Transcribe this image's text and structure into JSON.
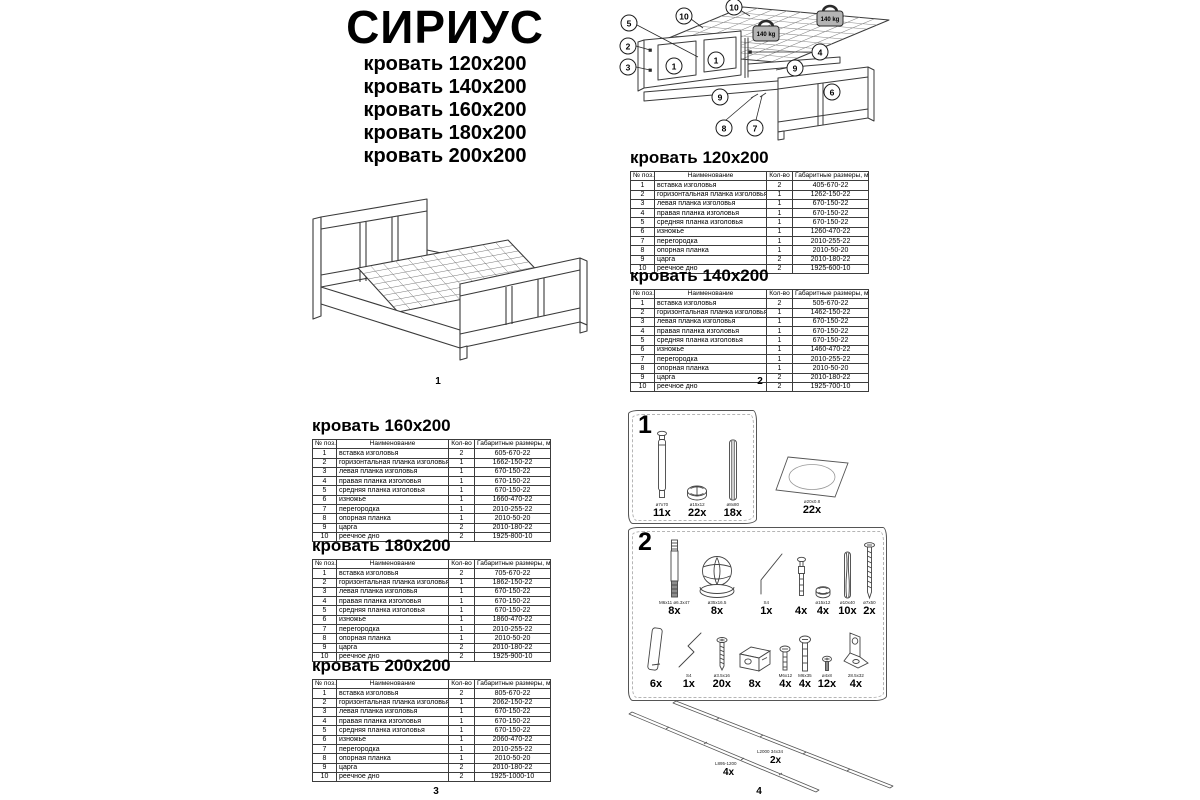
{
  "page": {
    "title": "СИРИУС",
    "sizes": [
      "кровать 120х200",
      "кровать 140х200",
      "кровать 160х200",
      "кровать 180х200",
      "кровать 200х200"
    ],
    "page_numbers": [
      "1",
      "2",
      "3",
      "4"
    ]
  },
  "table_header": [
    "№ поз.",
    "Наименование",
    "Кол-во",
    "Габаритные размеры, мм"
  ],
  "part_names": [
    "вставка изголовья",
    "горизонтальная планка изголовья",
    "левая планка изголовья",
    "правая планка изголовья",
    "средняя планка изголовья",
    "изножье",
    "перегородка",
    "опорная планка",
    "царга",
    "реечное дно"
  ],
  "quantities": [
    "2",
    "1",
    "1",
    "1",
    "1",
    "1",
    "1",
    "1",
    "2",
    "2"
  ],
  "tables": [
    {
      "title": "кровать 120х200",
      "dims": [
        "405-670-22",
        "1262-150-22",
        "670-150-22",
        "670-150-22",
        "670-150-22",
        "1260-470-22",
        "2010-255-22",
        "2010-50-20",
        "2010-180-22",
        "1925-600-10"
      ]
    },
    {
      "title": "кровать 140х200",
      "dims": [
        "505-670-22",
        "1462-150-22",
        "670-150-22",
        "670-150-22",
        "670-150-22",
        "1460-470-22",
        "2010-255-22",
        "2010-50-20",
        "2010-180-22",
        "1925-700-10"
      ]
    },
    {
      "title": "кровать 160х200",
      "dims": [
        "605-670-22",
        "1662-150-22",
        "670-150-22",
        "670-150-22",
        "670-150-22",
        "1660-470-22",
        "2010-255-22",
        "2010-50-20",
        "2010-180-22",
        "1925-800-10"
      ]
    },
    {
      "title": "кровать 180х200",
      "dims": [
        "705-670-22",
        "1862-150-22",
        "670-150-22",
        "670-150-22",
        "670-150-22",
        "1860-470-22",
        "2010-255-22",
        "2010-50-20",
        "2010-180-22",
        "1925-900-10"
      ]
    },
    {
      "title": "кровать 200х200",
      "dims": [
        "805-670-22",
        "2062-150-22",
        "670-150-22",
        "670-150-22",
        "670-150-22",
        "2060-470-22",
        "2010-255-22",
        "2010-50-20",
        "2010-180-22",
        "1925-1000-10"
      ]
    }
  ],
  "diagram": {
    "weight_label": "140 kg",
    "callouts": [
      {
        "n": "5",
        "x": 21,
        "y": 23
      },
      {
        "n": "2",
        "x": 20,
        "y": 46
      },
      {
        "n": "3",
        "x": 20,
        "y": 67
      },
      {
        "n": "10",
        "x": 76,
        "y": 16
      },
      {
        "n": "10",
        "x": 126,
        "y": 7
      },
      {
        "n": "1",
        "x": 66,
        "y": 66
      },
      {
        "n": "1",
        "x": 108,
        "y": 60
      },
      {
        "n": "4",
        "x": 212,
        "y": 52
      },
      {
        "n": "9",
        "x": 187,
        "y": 68
      },
      {
        "n": "6",
        "x": 224,
        "y": 92
      },
      {
        "n": "9",
        "x": 112,
        "y": 97
      },
      {
        "n": "8",
        "x": 116,
        "y": 128
      },
      {
        "n": "7",
        "x": 147,
        "y": 128
      }
    ]
  },
  "hardware_step1": {
    "step": "1",
    "items": [
      {
        "size": "ø7х70",
        "count": "11x"
      },
      {
        "size": "ø15х12",
        "count": "22x"
      },
      {
        "size": "ø8х80",
        "count": "18x"
      }
    ],
    "sticker": {
      "size": "ø20х0.8",
      "count": "22x"
    }
  },
  "hardware_step2": {
    "step": "2",
    "row1": [
      {
        "size": "M6х11 ø6.3х47",
        "count": "8x"
      },
      {
        "size": "ø35х16.5",
        "count": "8x"
      },
      {
        "size": "S4",
        "count": "1x"
      },
      {
        "size": "",
        "count": "4x"
      },
      {
        "size": "ø15х12",
        "count": "4x"
      },
      {
        "size": "ø10х40",
        "count": "10x"
      },
      {
        "size": "ø7х50",
        "count": "2x"
      }
    ],
    "row2": [
      {
        "size": "",
        "count": "6x"
      },
      {
        "size": "S4",
        "count": "1x"
      },
      {
        "size": "ø3.5х16",
        "count": "20x"
      },
      {
        "size": "",
        "count": "8x"
      },
      {
        "size": "M6х12",
        "count": "4x"
      },
      {
        "size": "M6х35",
        "count": "4x"
      },
      {
        "size": "ø4х8",
        "count": "12x"
      },
      {
        "size": "28.5х32",
        "count": "4x"
      }
    ]
  },
  "slats": [
    {
      "label": "L2000 34х34",
      "count": "2x"
    },
    {
      "label": "L895-1200",
      "count": "4x"
    }
  ]
}
